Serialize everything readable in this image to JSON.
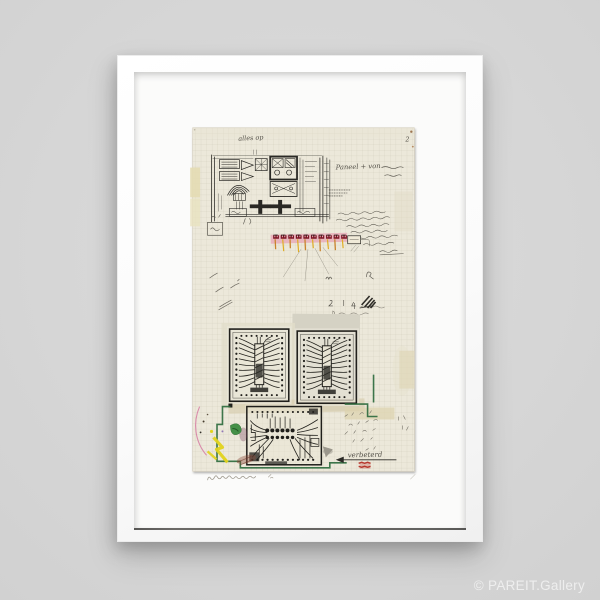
{
  "watermark": {
    "text": "© PAREIT.Gallery"
  },
  "artwork": {
    "inscriptions": {
      "top_note": "alles op",
      "page_number": "2",
      "side_note": "Paneel + von",
      "arrow_note": "verbeterd"
    }
  },
  "palette": {
    "background": "#d6d6d6",
    "frame_white": "#fbfbfa",
    "mat_white": "#fcfcfb",
    "paper": "#ece8da",
    "grid_line": "#b8b49f",
    "ink": "#2a2925",
    "pencil": "#6e6a60",
    "red_component": "#7c1322",
    "pink_highlight": "#e8a9b6",
    "orange_stroke": "#c9832a",
    "yellow_paint": "#e2d31c",
    "green_paint": "#3c8c40",
    "green_outline": "#2e6b3e",
    "pink_line": "#d77fa5",
    "red_stamp": "#b3281e",
    "shadow_line": "#454441"
  }
}
